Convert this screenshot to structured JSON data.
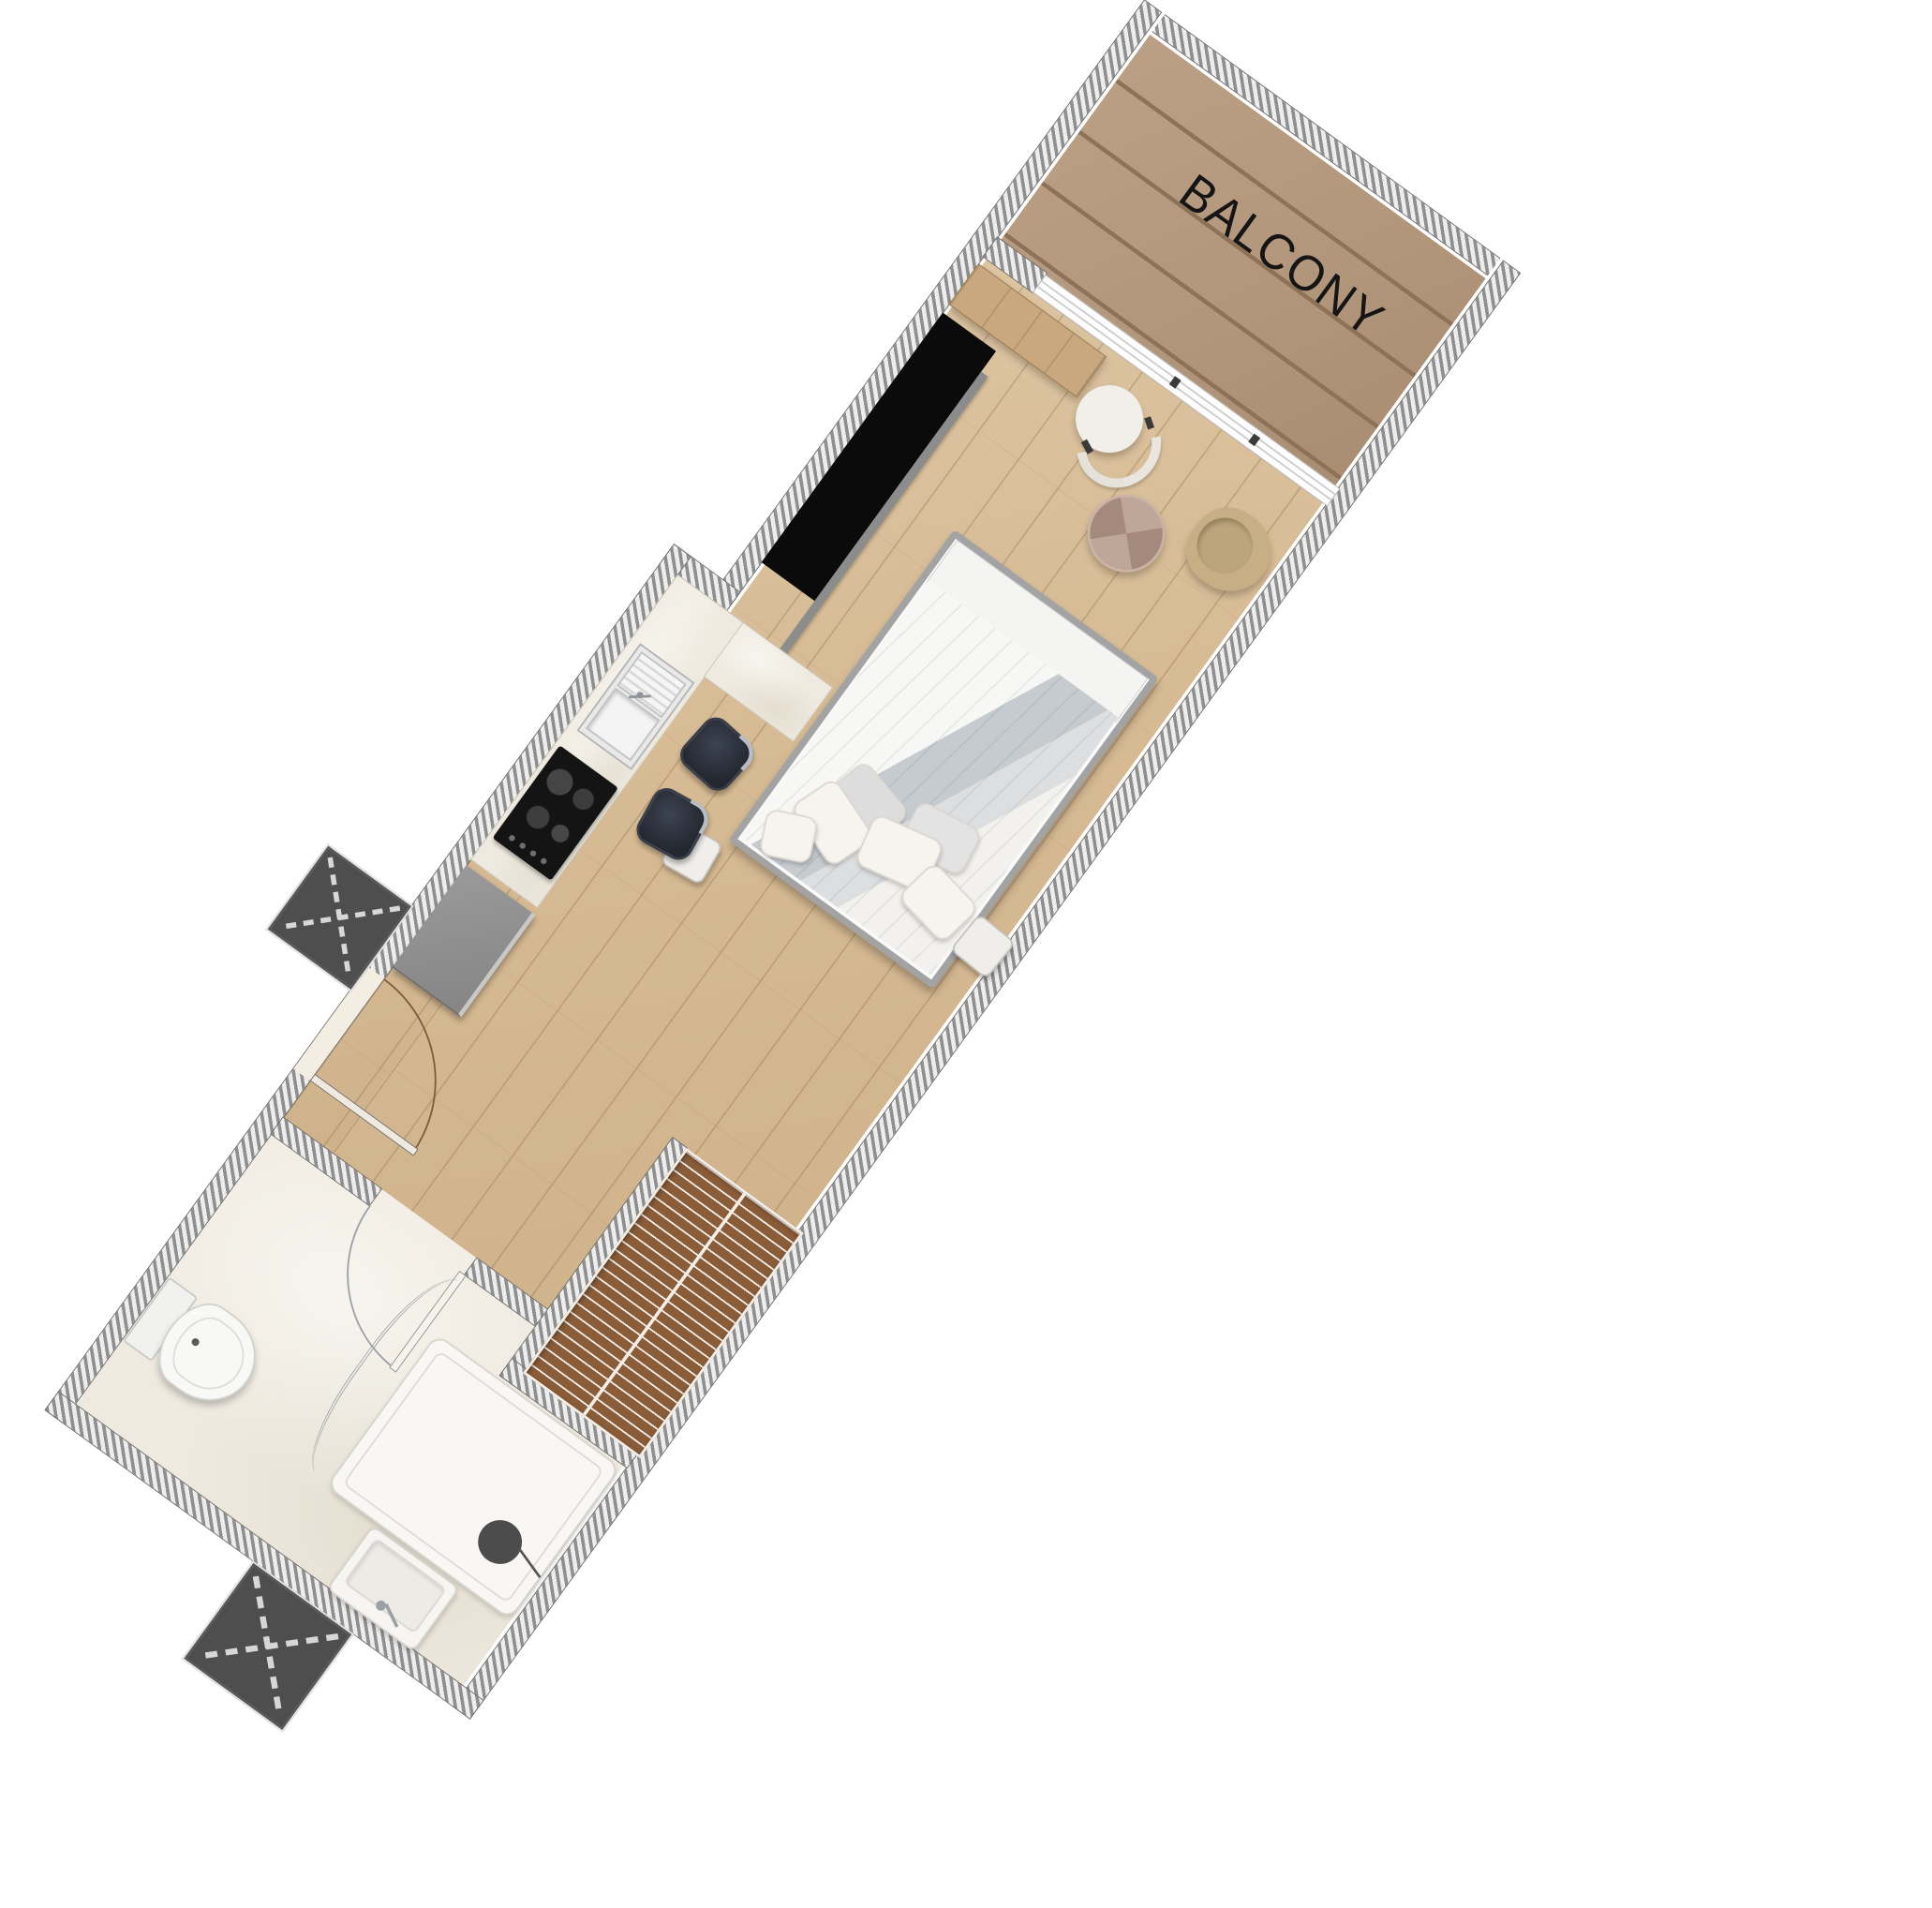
{
  "page": {
    "type": "apartment studio floor plan, top-down render, rotated clockwise",
    "background": "#ffffff",
    "rotation_deg": 36
  },
  "plan": {
    "labels": {
      "balcony": "BALCONY"
    },
    "rooms": [
      {
        "name": "balcony",
        "label": "BALCONY",
        "floor": "wood deck planks"
      },
      {
        "name": "living-bedroom",
        "floor": "light oak planks"
      },
      {
        "name": "kitchenette",
        "floor": "light oak planks"
      },
      {
        "name": "entry",
        "floor": "light oak planks"
      },
      {
        "name": "bathroom",
        "floor": "white marble"
      }
    ],
    "furniture_icons": [
      "sliding-glass-door-icon",
      "console-desk-icon",
      "round-chair-icon",
      "pouf-icon",
      "armchair-icon",
      "tv-wardrobe-icon",
      "shelf-ledge-icon",
      "double-bed-icon",
      "pillow-icon",
      "nightstand-icon",
      "kitchen-counter-icon",
      "sink-icon",
      "cooktop-icon",
      "bar-stool-icon",
      "fridge-icon",
      "entry-door-swing-icon",
      "louver-wardrobe-icon",
      "bathroom-door-swing-icon",
      "shower-tray-icon",
      "shower-glass-icon",
      "toilet-icon",
      "washbasin-icon",
      "service-shaft-x-icon"
    ],
    "colors": {
      "wall_hatch_dark": "#8f8f8f",
      "wall_hatch_light": "#ededed",
      "wood_floor": "#d6ba93",
      "balcony_deck": "#b2967b",
      "marble_floor": "#efeadf",
      "tv_wardrobe_black": "#0b0b0b",
      "appliance_gray": "#8f8f8f",
      "shaft_gray": "#4e4e4e",
      "stool_dark": "#2a2f39",
      "armchair_olive": "#c7ae85",
      "pouf_brown": "#b59a8b",
      "louver_brown": "#8a5c38",
      "bedding_gray": "#c6cbd0",
      "label_text": "#151515"
    }
  }
}
